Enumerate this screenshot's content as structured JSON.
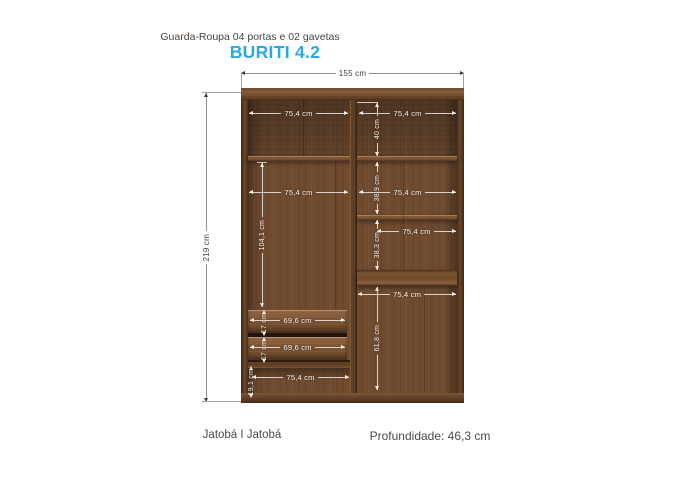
{
  "header": {
    "subtitle": "Guarda-Roupa 04 portas e 02 gavetas",
    "title": "BURITI 4.2"
  },
  "footer": {
    "finish": "Jatobá I Jatobá",
    "depth_label": "Profundidade: 46,3 cm"
  },
  "colors": {
    "accent": "#29a9e0",
    "wood_base": "#6f4b30",
    "wood_frame_dark": "#4a2f1c",
    "dimension_text_dark": "#3e3e3e",
    "dimension_text_light": "#f7f1e9"
  },
  "dimensions": {
    "overall_width": "155 cm",
    "overall_height": "219 cm",
    "left_top_width": "75,4 cm",
    "right_top_width": "75,4 cm",
    "top_section_height": "40 cm",
    "left_main_width": "75,4 cm",
    "left_main_height": "104,1 cm",
    "right_section2_width": "75,4 cm",
    "right_section2_height": "38,9 cm",
    "right_section3_width": "75,4 cm",
    "right_section3_height": "38,3 cm",
    "right_bottom_width": "75,4 cm",
    "right_bottom_height": "61,8 cm",
    "drawer1_width": "69,6 cm",
    "drawer1_height": "17 cm",
    "drawer2_width": "69,6 cm",
    "drawer2_height": "17 cm",
    "left_bottom_width": "75,4 cm",
    "left_bottom_height": "19,1 cm"
  }
}
